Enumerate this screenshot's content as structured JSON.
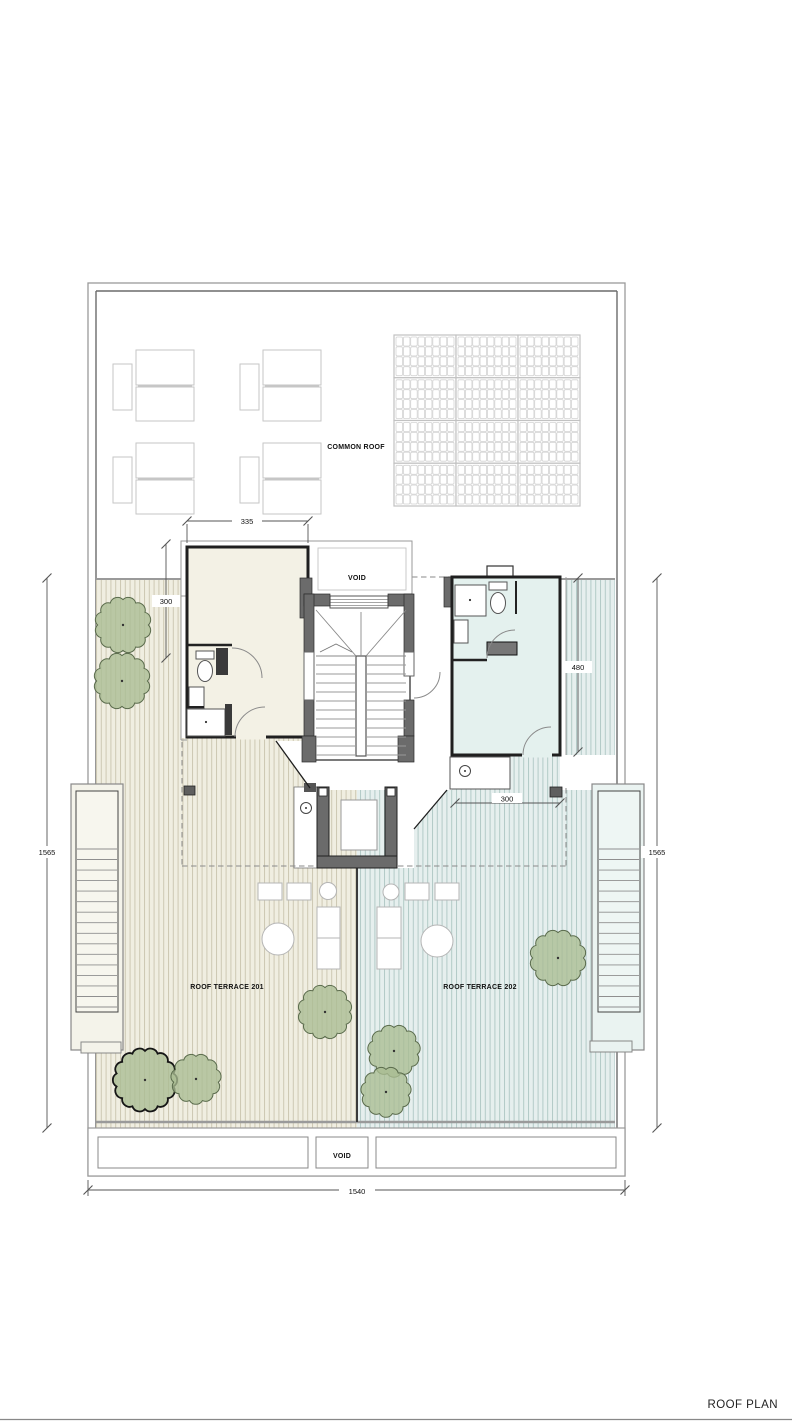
{
  "sheet": {
    "title": "ROOF PLAN"
  },
  "labels": {
    "common_roof": "COMMON ROOF",
    "void_upper": "VOID",
    "void_lower": "VOID",
    "terrace_201": "ROOF TERRACE 201",
    "terrace_202": "ROOF TERRACE 202"
  },
  "dimensions": {
    "access_room_width": "335",
    "access_room_depth": "300",
    "room_202_depth": "480",
    "terrace_202_setback": "300",
    "plan_depth_left": "1565",
    "plan_depth_right": "1565",
    "plan_width": "1540"
  },
  "colors": {
    "wall": "#1f1f1f",
    "pier_gray": "#6b6b6b",
    "deck_201": "#f0eee1",
    "deck_202": "#e6efee",
    "room_201_fill": "#f3f1e5",
    "room_202_fill": "#e4f1ee",
    "tree_fill": "#a9bd92",
    "tree_stroke": "#5a6b4c",
    "dim_line": "#555555",
    "furniture_stroke": "#c6c6c6"
  },
  "landscape": {
    "trees": [
      {
        "cx": 123,
        "cy": 625,
        "r": 27,
        "bold": false
      },
      {
        "cx": 122,
        "cy": 681,
        "r": 27,
        "bold": false
      },
      {
        "cx": 325,
        "cy": 1012,
        "r": 26,
        "bold": false
      },
      {
        "cx": 145,
        "cy": 1080,
        "r": 31,
        "bold": true
      },
      {
        "cx": 196,
        "cy": 1079,
        "r": 24,
        "bold": false
      },
      {
        "cx": 558,
        "cy": 958,
        "r": 27,
        "bold": false
      },
      {
        "cx": 394,
        "cy": 1051,
        "r": 25,
        "bold": false
      },
      {
        "cx": 386,
        "cy": 1092,
        "r": 24,
        "bold": false
      }
    ]
  },
  "furniture": {
    "lounger_sets": [
      {
        "x": 113,
        "y": 346
      },
      {
        "x": 240,
        "y": 346
      },
      {
        "x": 113,
        "y": 439
      },
      {
        "x": 240,
        "y": 439
      }
    ]
  },
  "equipment": {
    "solar_array": {
      "x": 394,
      "y": 335,
      "panel_cols": 3,
      "panel_rows": 4,
      "panel_w": 62,
      "panel_h": 42.75,
      "cells_x": 8,
      "cells_y": 4
    }
  }
}
